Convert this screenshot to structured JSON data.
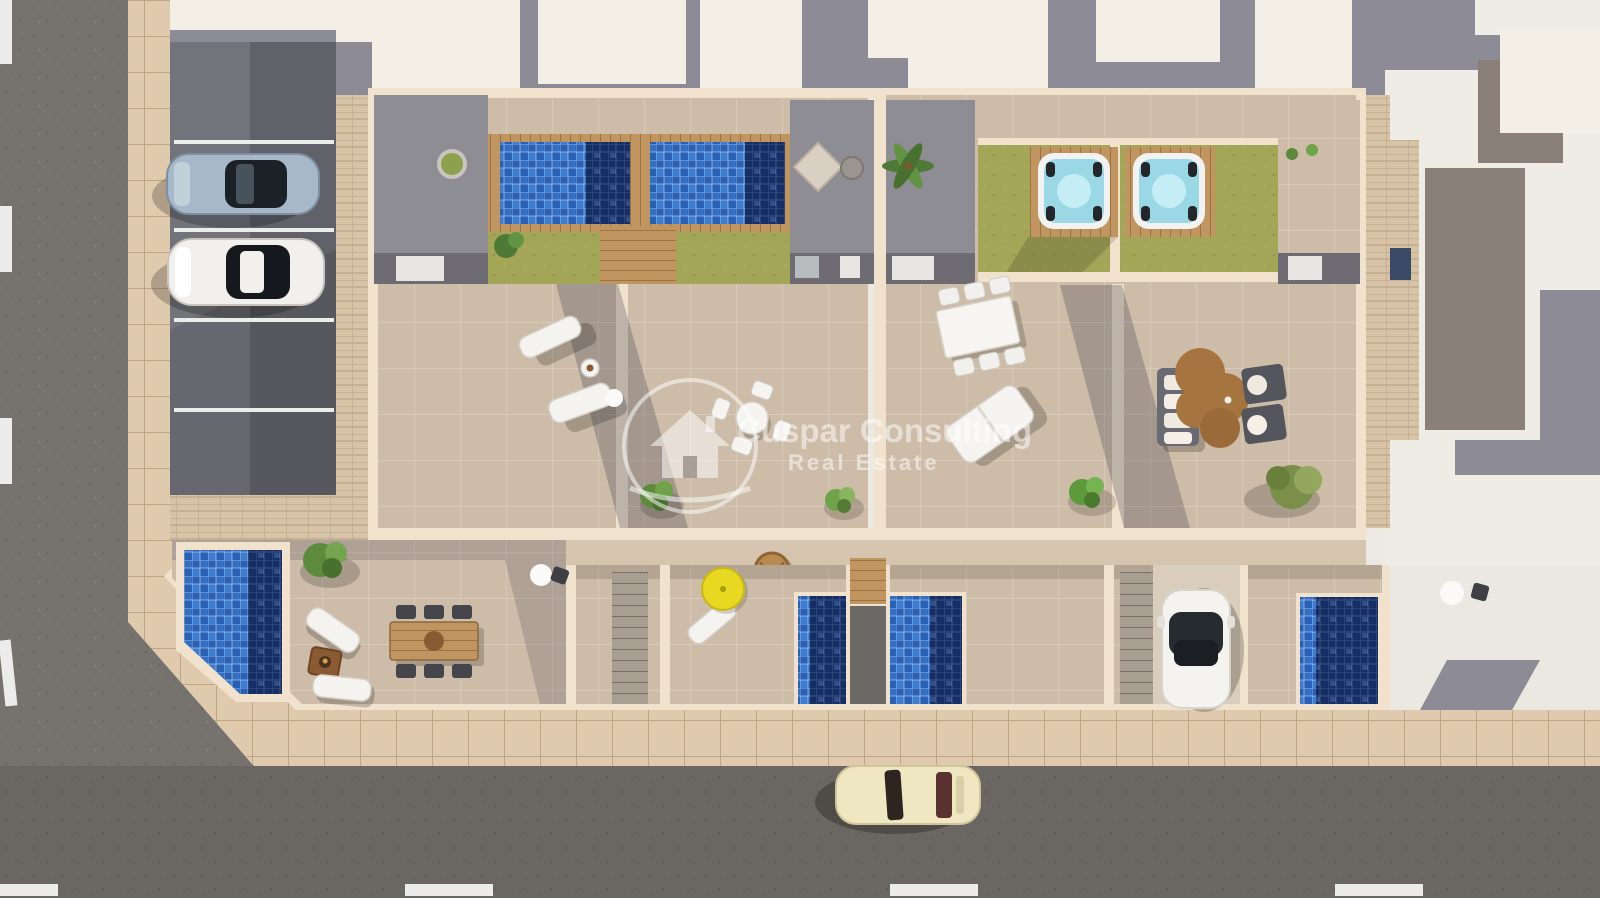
{
  "scene": {
    "type": "aerial-3d-architectural-render",
    "description": "Top-down 3D render of a row of new-build townhouses with rooftop pools, hot tubs, terraces, gardens, private parking and surrounding streets",
    "watermark": {
      "brand": "Cuspar Consulting",
      "tagline": "Real Estate",
      "logo": "house-in-circle"
    },
    "objects": {
      "parked_cars": [
        "steel-blue car",
        "white car"
      ],
      "street_car": "cream classic car",
      "driveway_car": "white compact car",
      "rooftop_pools": 2,
      "hot_tubs": 2,
      "ground_floor_pools": 4,
      "furniture": [
        "sun loungers",
        "round terrace table with chairs",
        "rectangular dining table with chairs",
        "outdoor sofa set with rug",
        "wooden garden dining table",
        "yellow parasol",
        "hanging chair",
        "fire pit",
        "outdoor kitchens"
      ]
    }
  },
  "palette": {
    "asphalt": "#76726d",
    "asphaltDark": "#5f5d5a",
    "sidewalk": "#e0caae",
    "grout": "#c0a585",
    "paver": "#d7c3a6",
    "parking": "#73737c",
    "parkingDark": "#616169",
    "line": "#ececea",
    "roofWhite": "#f3efe7",
    "shadowGray": "#8d8b96",
    "roofTaupe": "#8b8078",
    "terrace": "#cdbca7",
    "midBand": "#d6c5ae",
    "wallCream": "#f1e2cd",
    "lawn": "#a3a557",
    "grayTerrace": "#8f8d94",
    "darkStrip": "#6e6c72",
    "poolLight": "#4384d6",
    "poolMid": "#2760b4",
    "poolDark": "#152f66",
    "hotTub": "#9ad8e6",
    "wood": "#c0955f",
    "woodDark": "#9a7344",
    "watermark": "rgba(255,255,255,0.52)"
  }
}
